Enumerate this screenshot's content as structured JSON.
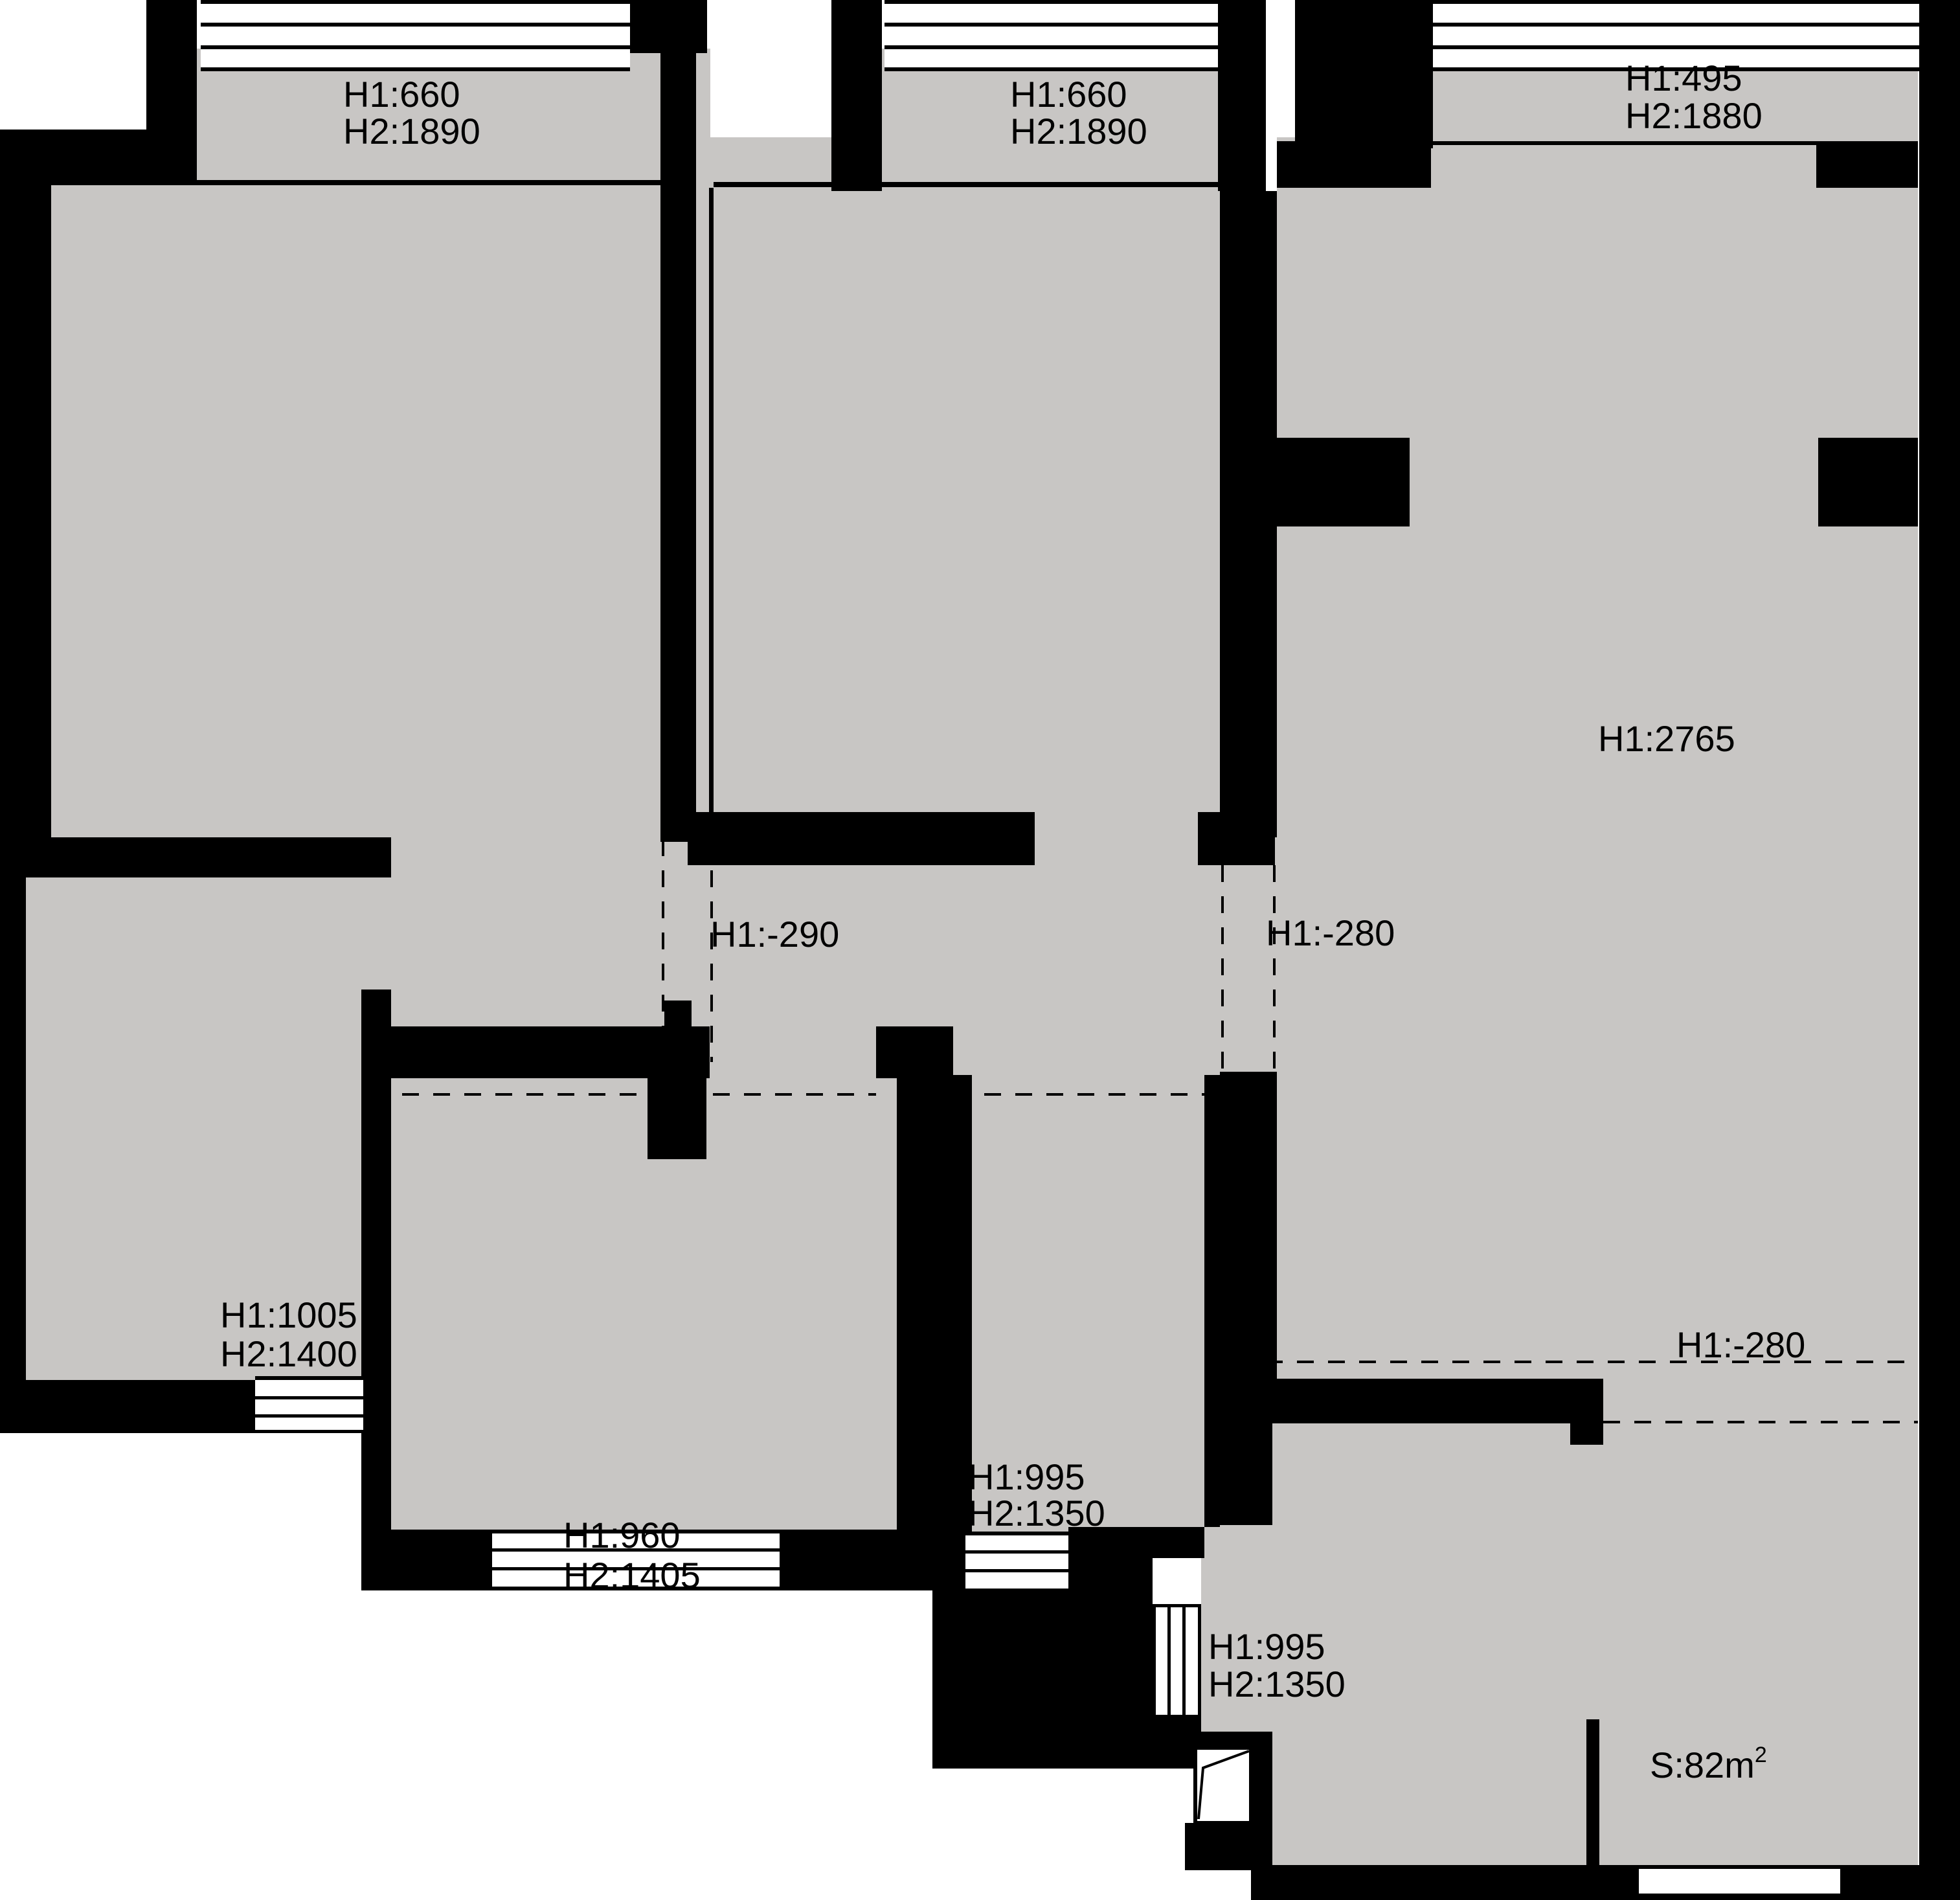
{
  "plan_title": "apartment-floor-plan",
  "colors": {
    "wall": "#000000",
    "floor": "#c8c6c4",
    "background": "#ffffff",
    "annotation_text": "#000000"
  },
  "annotations": {
    "bay_top_left": {
      "line1": "H1:660",
      "line2": "H2:1890"
    },
    "bay_top_middle": {
      "line1": "H1:660",
      "line2": "H2:1890"
    },
    "bay_top_right": {
      "line1": "H1:495",
      "line2": "H2:1880"
    },
    "right_room": {
      "line1": "H1:2765"
    },
    "hall_opening_left": {
      "line1": "H1:-290"
    },
    "hall_opening_right": {
      "line1": "H1:-280"
    },
    "lower_left_room": {
      "line1": "H1:1005",
      "line2": "H2:1400"
    },
    "bottom_middle_room": {
      "line1": "H1:960",
      "line2": "H2:1405"
    },
    "bathroom": {
      "line1": "H1:995",
      "line2": "H2:1350"
    },
    "balcony_side_window": {
      "line1": "H1:995",
      "line2": "H2:1350"
    },
    "balcony_opening": {
      "line1": "H1:-280"
    },
    "total_area": {
      "prefix": "S:82m",
      "sup": "2"
    }
  }
}
